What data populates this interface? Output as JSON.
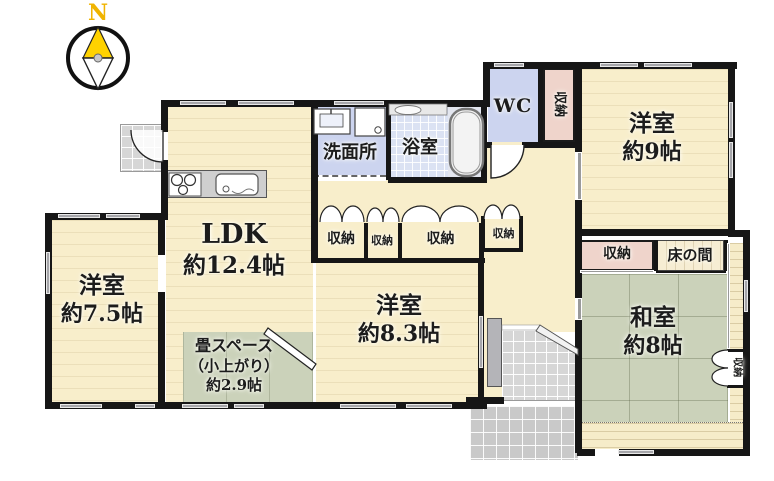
{
  "title": "floor-plan",
  "compass": {
    "north_label": "N"
  },
  "rooms": {
    "ldk": {
      "name": "LDK",
      "size": "約12.4帖"
    },
    "western_room_75": {
      "name": "洋室",
      "size": "約7.5帖"
    },
    "tatami_corner": {
      "line1": "畳スペース",
      "line2": "（小上がり）",
      "line3": "約2.9帖"
    },
    "western_room_83": {
      "name": "洋室",
      "size": "約8.3帖"
    },
    "western_room_9": {
      "name": "洋室",
      "size": "約9帖"
    },
    "japanese_room": {
      "name": "和室",
      "size": "約8帖"
    },
    "washroom": {
      "name": "洗面所"
    },
    "bathroom": {
      "name": "浴室"
    },
    "toilet": {
      "name": "WC"
    },
    "tokonoma": {
      "name": "床の間"
    }
  },
  "closets": {
    "beside_wc": {
      "label": "収納"
    },
    "hall_1": {
      "label": "収納"
    },
    "hall_2": {
      "label": "収納"
    },
    "hall_3": {
      "label": "収納"
    },
    "hall_4": {
      "label": "収納"
    },
    "japanese_room_main": {
      "label": "収納"
    },
    "japanese_room_small": {
      "label": "収納"
    }
  },
  "colors": {
    "wall": "#161616",
    "wood_floor": "#f8eecb",
    "tatami": "#cbd2ba",
    "closet_pink": "#efd4cb",
    "wet_blue": "#ccd4ef",
    "bath_tile": "#dbe2f3",
    "entry_tile": "#d6d6d6",
    "porch_tile": "#c9c9c9",
    "window_gray": "#a6a6aa",
    "compass_gold": "#f5c400"
  }
}
